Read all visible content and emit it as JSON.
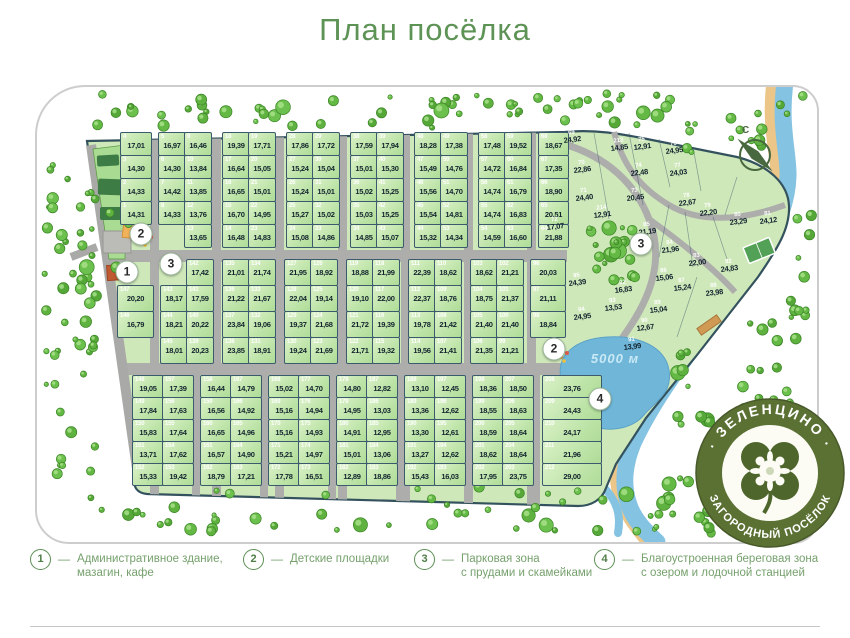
{
  "title": "План посёлка",
  "compass_label": "С",
  "lake_label": "5000 м",
  "legend_dash": "—",
  "logo": {
    "top_text": "· ЗЕЛЕНЦИНО ·",
    "bottom_text": "ЗАГОРОДНЫЙ ПОСЁЛОК"
  },
  "colors": {
    "title_green": "#5e9356",
    "plot_fill": "#bfe5ab",
    "plot_border": "#3c5a6d",
    "road_gray": "#adadab",
    "water_blue": "#85c3e2",
    "lake_blue": "#6fb6d8",
    "sand": "#ecc689",
    "tree_green": "#5fb23f",
    "logo_olive": "#5b7133",
    "legend_green": "#76a16d"
  },
  "legend": [
    {
      "num": "1",
      "line1": "Административное здание,",
      "line2": "мазагин, кафе"
    },
    {
      "num": "2",
      "line1": "Детские площадки",
      "line2": ""
    },
    {
      "num": "3",
      "line1": "Парковая зона",
      "line2": "с прудами и скамейками"
    },
    {
      "num": "4",
      "line1": "Благоустроенная береговая зона",
      "line2": "с озером и лодочной станцией"
    }
  ],
  "markers": [
    {
      "label": "2"
    },
    {
      "label": "1"
    },
    {
      "label": "3"
    },
    {
      "label": "3"
    },
    {
      "label": "2"
    },
    {
      "label": "4"
    }
  ],
  "blocks": {
    "top": {
      "rows": [
        [
          {
            "n": "4",
            "a": "17,01"
          },
          {
            "n": "5",
            "a": "16,97"
          },
          {
            "n": "9",
            "a": "16,46"
          },
          {
            "n": "18",
            "a": "19,39"
          },
          {
            "n": "19",
            "a": "17,71"
          },
          {
            "n": "28",
            "a": "17,86"
          },
          {
            "n": "29",
            "a": "17,72"
          },
          {
            "n": "38",
            "a": "17,59"
          },
          {
            "n": "39",
            "a": "17,94"
          },
          {
            "n": "48",
            "a": "18,28"
          },
          {
            "n": "49",
            "a": "17,38"
          },
          {
            "n": "58",
            "a": "17,48"
          },
          {
            "n": "59",
            "a": "19,52"
          },
          {
            "n": "68",
            "a": "18,67"
          }
        ],
        [
          {
            "n": "3",
            "a": "14,30"
          },
          {
            "n": "6",
            "a": "14,30"
          },
          {
            "n": "10",
            "a": "13,84"
          },
          {
            "n": "17",
            "a": "16,64"
          },
          {
            "n": "20",
            "a": "15,05"
          },
          {
            "n": "27",
            "a": "15,24"
          },
          {
            "n": "30",
            "a": "15,04"
          },
          {
            "n": "37",
            "a": "15,01"
          },
          {
            "n": "40",
            "a": "15,30"
          },
          {
            "n": "47",
            "a": "15,49"
          },
          {
            "n": "50",
            "a": "14,76"
          },
          {
            "n": "57",
            "a": "14,72"
          },
          {
            "n": "60",
            "a": "16,84"
          },
          {
            "n": "67",
            "a": "17,35"
          }
        ],
        [
          {
            "n": "2",
            "a": "14,33"
          },
          {
            "n": "7",
            "a": "14,42"
          },
          {
            "n": "11",
            "a": "13,85"
          },
          {
            "n": "16",
            "a": "16,65"
          },
          {
            "n": "21",
            "a": "15,01"
          },
          {
            "n": "26",
            "a": "15,24"
          },
          {
            "n": "31",
            "a": "15,01"
          },
          {
            "n": "36",
            "a": "15,02"
          },
          {
            "n": "41",
            "a": "15,25"
          },
          {
            "n": "46",
            "a": "15,56"
          },
          {
            "n": "51",
            "a": "14,70"
          },
          {
            "n": "56",
            "a": "14,74"
          },
          {
            "n": "61",
            "a": "16,79"
          },
          {
            "n": "66",
            "a": "18,90"
          }
        ],
        [
          {
            "n": "1",
            "a": "14,31"
          },
          {
            "n": "8",
            "a": "14,33"
          },
          {
            "n": "12",
            "a": "13,76"
          },
          {
            "n": "15",
            "a": "16,70"
          },
          {
            "n": "22",
            "a": "14,95"
          },
          {
            "n": "25",
            "a": "15,27"
          },
          {
            "n": "32",
            "a": "15,02"
          },
          {
            "n": "35",
            "a": "15,03"
          },
          {
            "n": "42",
            "a": "15,25"
          },
          {
            "n": "45",
            "a": "15,54"
          },
          {
            "n": "52",
            "a": "14,81"
          },
          {
            "n": "55",
            "a": "14,74"
          },
          {
            "n": "62",
            "a": "16,83"
          },
          {
            "n": "65",
            "a": "20,51"
          }
        ],
        [
          {
            "n": "13",
            "a": "13,65"
          },
          {
            "n": "14",
            "a": "16,48"
          },
          {
            "n": "23",
            "a": "14,83"
          },
          {
            "n": "24",
            "a": "15,08"
          },
          {
            "n": "33",
            "a": "14,86"
          },
          {
            "n": "34",
            "a": "14,85"
          },
          {
            "n": "43",
            "a": "15,07"
          },
          {
            "n": "44",
            "a": "15,32"
          },
          {
            "n": "53",
            "a": "14,34"
          },
          {
            "n": "54",
            "a": "14,59"
          },
          {
            "n": "63",
            "a": "16,60"
          },
          {
            "n": "64",
            "a": "21,88"
          }
        ]
      ]
    },
    "middle": {
      "rows": [
        [
          {
            "n": "142",
            "a": "17,42"
          },
          {
            "n": "135",
            "a": "21,01"
          },
          {
            "n": "134",
            "a": "21,74"
          },
          {
            "n": "127",
            "a": "21,95"
          },
          {
            "n": "126",
            "a": "18,92"
          },
          {
            "n": "119",
            "a": "18,88"
          },
          {
            "n": "118",
            "a": "21,99"
          },
          {
            "n": "111",
            "a": "22,39"
          },
          {
            "n": "110",
            "a": "18,62"
          },
          {
            "n": "103",
            "a": "18,62"
          },
          {
            "n": "102",
            "a": "21,21"
          },
          {
            "n": "96",
            "a": "20,03"
          }
        ],
        [
          {
            "n": "147",
            "a": "20,20"
          },
          {
            "n": "143",
            "a": "18,17"
          },
          {
            "n": "141",
            "a": "17,59"
          },
          {
            "n": "136",
            "a": "21,22"
          },
          {
            "n": "133",
            "a": "21,67"
          },
          {
            "n": "128",
            "a": "22,04"
          },
          {
            "n": "125",
            "a": "19,14"
          },
          {
            "n": "120",
            "a": "19,10"
          },
          {
            "n": "117",
            "a": "22,00"
          },
          {
            "n": "112",
            "a": "22,37"
          },
          {
            "n": "109",
            "a": "18,76"
          },
          {
            "n": "104",
            "a": "18,75"
          },
          {
            "n": "101",
            "a": "21,37"
          },
          {
            "n": "97",
            "a": "21,11"
          }
        ],
        [
          {
            "n": "146",
            "a": "16,79"
          },
          {
            "n": "144",
            "a": "18,21"
          },
          {
            "n": "140",
            "a": "20,22"
          },
          {
            "n": "137",
            "a": "23,84"
          },
          {
            "n": "132",
            "a": "19,06"
          },
          {
            "n": "129",
            "a": "19,37"
          },
          {
            "n": "124",
            "a": "21,68"
          },
          {
            "n": "121",
            "a": "21,72"
          },
          {
            "n": "116",
            "a": "19,39"
          },
          {
            "n": "113",
            "a": "19,78"
          },
          {
            "n": "108",
            "a": "21,42"
          },
          {
            "n": "105",
            "a": "21,40"
          },
          {
            "n": "100",
            "a": "21,40"
          },
          {
            "n": "98",
            "a": "18,84"
          }
        ],
        [
          {
            "n": "145",
            "a": "18,01"
          },
          {
            "n": "139",
            "a": "20,23"
          },
          {
            "n": "138",
            "a": "23,85"
          },
          {
            "n": "131",
            "a": "18,91"
          },
          {
            "n": "130",
            "a": "19,24"
          },
          {
            "n": "123",
            "a": "21,69"
          },
          {
            "n": "122",
            "a": "21,71"
          },
          {
            "n": "115",
            "a": "19,32"
          },
          {
            "n": "114",
            "a": "19,56"
          },
          {
            "n": "107",
            "a": "21,41"
          },
          {
            "n": "106",
            "a": "21,35"
          },
          {
            "n": "99",
            "a": "21,21"
          }
        ]
      ]
    },
    "bottom": {
      "rows": [
        [
          {
            "n": "148",
            "a": "19,05"
          },
          {
            "n": "157",
            "a": "17,39"
          },
          {
            "n": "158",
            "a": "16,44"
          },
          {
            "n": "167",
            "a": "14,79"
          },
          {
            "n": "168",
            "a": "15,02"
          },
          {
            "n": "177",
            "a": "14,70"
          },
          {
            "n": "178",
            "a": "14,80"
          },
          {
            "n": "187",
            "a": "12,82"
          },
          {
            "n": "188",
            "a": "13,10"
          },
          {
            "n": "197",
            "a": "12,45"
          },
          {
            "n": "198",
            "a": "18,36"
          },
          {
            "n": "207",
            "a": "18,50"
          },
          {
            "n": "208",
            "a": "23,76"
          }
        ],
        [
          {
            "n": "149",
            "a": "17,84"
          },
          {
            "n": "156",
            "a": "17,63"
          },
          {
            "n": "159",
            "a": "16,56"
          },
          {
            "n": "166",
            "a": "14,92"
          },
          {
            "n": "169",
            "a": "15,16"
          },
          {
            "n": "176",
            "a": "14,94"
          },
          {
            "n": "179",
            "a": "14,95"
          },
          {
            "n": "186",
            "a": "13,03"
          },
          {
            "n": "189",
            "a": "13,36"
          },
          {
            "n": "196",
            "a": "12,62"
          },
          {
            "n": "199",
            "a": "18,55"
          },
          {
            "n": "206",
            "a": "18,63"
          },
          {
            "n": "209",
            "a": "24,43"
          }
        ],
        [
          {
            "n": "150",
            "a": "15,83"
          },
          {
            "n": "155",
            "a": "17,64"
          },
          {
            "n": "160",
            "a": "16,65"
          },
          {
            "n": "165",
            "a": "14,96"
          },
          {
            "n": "170",
            "a": "15,16"
          },
          {
            "n": "175",
            "a": "14,93"
          },
          {
            "n": "180",
            "a": "14,91"
          },
          {
            "n": "185",
            "a": "12,95"
          },
          {
            "n": "190",
            "a": "13,30"
          },
          {
            "n": "195",
            "a": "12,61"
          },
          {
            "n": "200",
            "a": "18,59"
          },
          {
            "n": "205",
            "a": "18,64"
          },
          {
            "n": "210",
            "a": "24,17"
          }
        ],
        [
          {
            "n": "151",
            "a": "13,71"
          },
          {
            "n": "154",
            "a": "17,62"
          },
          {
            "n": "161",
            "a": "16,57"
          },
          {
            "n": "164",
            "a": "14,90"
          },
          {
            "n": "171",
            "a": "15,21"
          },
          {
            "n": "174",
            "a": "14,97"
          },
          {
            "n": "181",
            "a": "15,01"
          },
          {
            "n": "184",
            "a": "13,06"
          },
          {
            "n": "191",
            "a": "13,27"
          },
          {
            "n": "194",
            "a": "12,62"
          },
          {
            "n": "201",
            "a": "18,62"
          },
          {
            "n": "204",
            "a": "18,64"
          },
          {
            "n": "211",
            "a": "21,96"
          }
        ],
        [
          {
            "n": "152",
            "a": "15,33"
          },
          {
            "n": "153",
            "a": "19,42"
          },
          {
            "n": "162",
            "a": "18,79"
          },
          {
            "n": "163",
            "a": "17,21"
          },
          {
            "n": "172",
            "a": "17,78"
          },
          {
            "n": "173",
            "a": "16,51"
          },
          {
            "n": "182",
            "a": "12,89"
          },
          {
            "n": "183",
            "a": "18,86"
          },
          {
            "n": "192",
            "a": "15,43"
          },
          {
            "n": "193",
            "a": "16,03"
          },
          {
            "n": "202",
            "a": "17,95"
          },
          {
            "n": "203",
            "a": "23,75"
          },
          {
            "n": "212",
            "a": "29,00"
          }
        ]
      ]
    }
  },
  "ne_plots": [
    {
      "n": "69",
      "a": "24,92"
    },
    {
      "n": "70",
      "a": "22,86"
    },
    {
      "n": "71",
      "a": "24,40"
    },
    {
      "n": "72",
      "a": "17,07"
    },
    {
      "n": "213",
      "a": "14,85"
    },
    {
      "n": "75",
      "a": "12,91"
    },
    {
      "n": "76",
      "a": "24,95"
    },
    {
      "n": "74",
      "a": "22,48"
    },
    {
      "n": "77",
      "a": "24,03"
    },
    {
      "n": "73",
      "a": "20,45"
    },
    {
      "n": "78",
      "a": "22,67"
    },
    {
      "n": "214",
      "a": "12,91"
    },
    {
      "n": "79",
      "a": "22,20"
    },
    {
      "n": "80",
      "a": "23,29"
    },
    {
      "n": "81",
      "a": "24,12"
    },
    {
      "n": "85",
      "a": "21,19"
    },
    {
      "n": "84",
      "a": "21,96"
    },
    {
      "n": "83",
      "a": "22,00"
    },
    {
      "n": "82",
      "a": "24,83"
    },
    {
      "n": "86",
      "a": "15,06"
    },
    {
      "n": "87",
      "a": "15,24"
    },
    {
      "n": "88",
      "a": "23,98"
    },
    {
      "n": "89",
      "a": "15,04"
    },
    {
      "n": "90",
      "a": "12,67"
    },
    {
      "n": "91",
      "a": "13,99"
    },
    {
      "n": "92",
      "a": "16,83"
    },
    {
      "n": "93",
      "a": "13,53"
    },
    {
      "n": "95",
      "a": "24,39"
    },
    {
      "n": "94",
      "a": "24,95"
    }
  ]
}
